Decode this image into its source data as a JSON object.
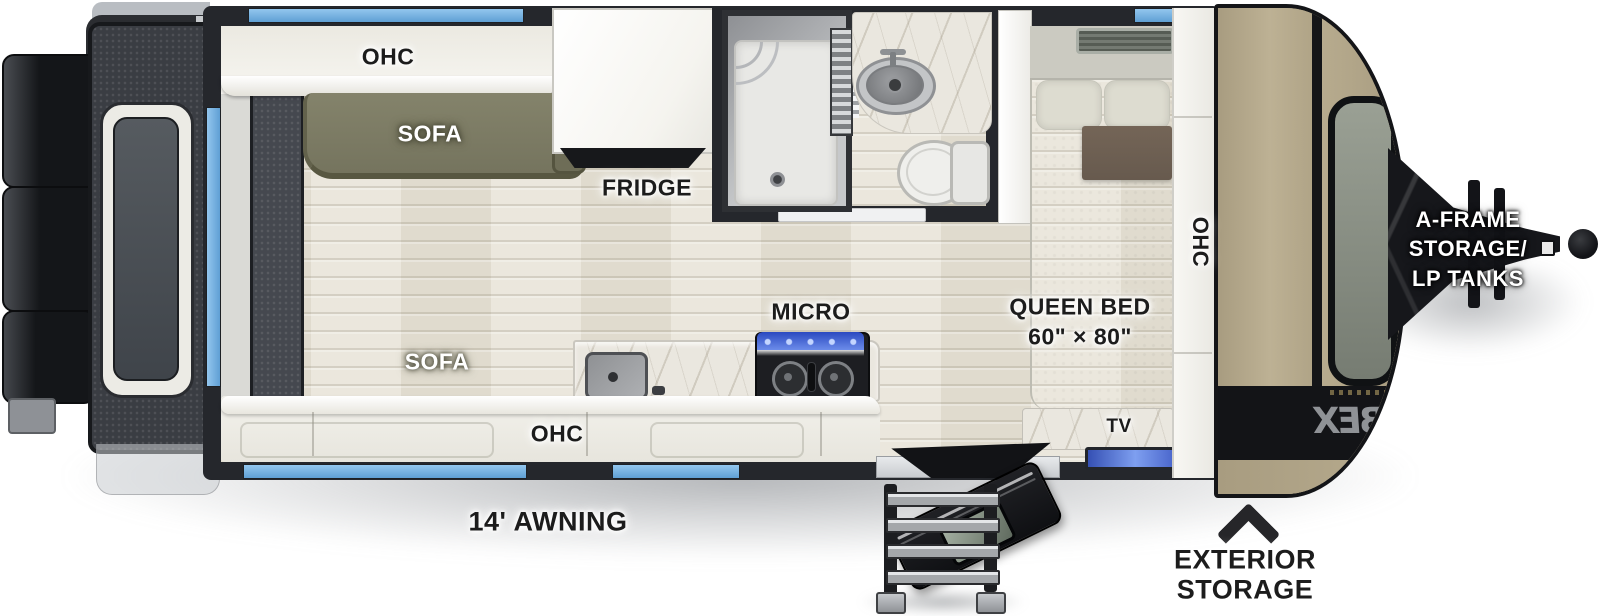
{
  "floorplan": {
    "cabinets": {
      "ohc": "OHC"
    },
    "living": {
      "sofa": "SOFA"
    },
    "kitchen": {
      "fridge": "FRIDGE",
      "micro": "MICRO"
    },
    "bedroom": {
      "queen_bed": "QUEEN BED",
      "queen_bed_size": "60\" × 80\"",
      "tv": "TV"
    },
    "exterior": {
      "awning": "14' AWNING",
      "aframe_line1": "A-FRAME",
      "aframe_line2": "STORAGE/",
      "aframe_line3": "LP TANKS",
      "exterior_storage_line1": "EXTERIOR",
      "exterior_storage_line2": "STORAGE",
      "cap_graphic": "IBEX"
    }
  },
  "colors": {
    "window_blue": "#6fb0e0",
    "wall_dark": "#25272c",
    "floor_wood": "#e8e4d8",
    "sofa_olive": "#7b7a63",
    "cabinet_white": "#f3f2ec",
    "marble": "#eae7df",
    "bed_linen": "#e0ded3",
    "throw_brown": "#6e6052",
    "tv_screen_blue": "#4a66cc",
    "front_cap_tan": "#b3a78a",
    "hitch_black": "#16171b"
  }
}
